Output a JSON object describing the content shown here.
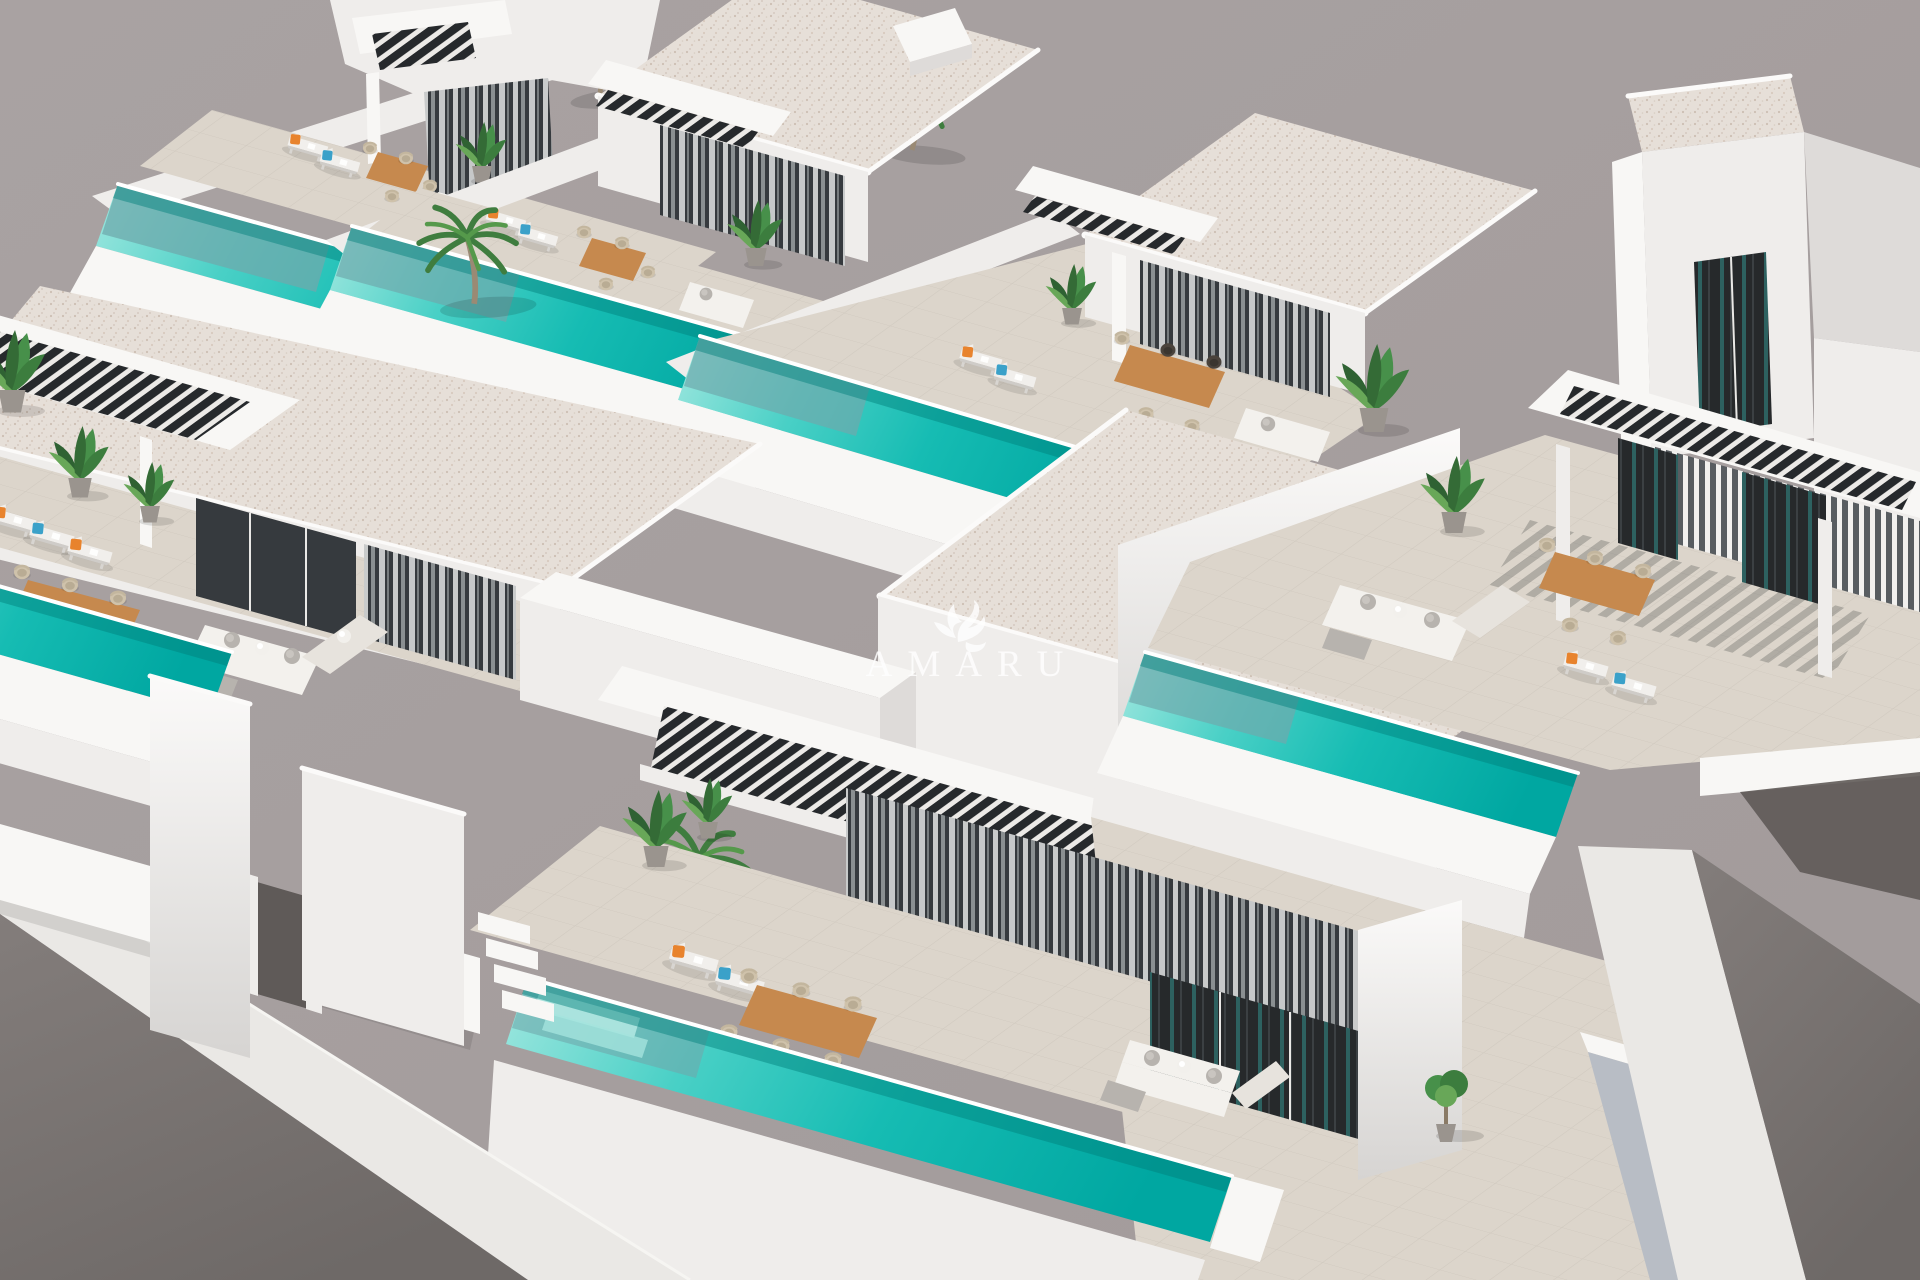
{
  "watermark": {
    "text": "AMARU",
    "logo": "amaru-bird-logo"
  },
  "scene": {
    "type": "3d-architectural-render",
    "subject": "Aerial view of a modern white villa development, each unit with a private turquoise lap pool",
    "villas_visible": 6,
    "elements": [
      "flat-roofed white villas",
      "black louvered pergolas",
      "turquoise pools",
      "sun loungers with orange and blue cushions",
      "teak outdoor dining tables with wicker chairs",
      "white corner sofas",
      "palm trees",
      "potted plants",
      "perimeter walls",
      "street with sidewalk"
    ]
  },
  "colors": {
    "bg": "#a9a2a2",
    "bg_edge": "#a29b9b",
    "white_top": "#f8f7f5",
    "white_front": "#efedeb",
    "white_side": "#dedbd9",
    "white_bright": "#fbfaf9",
    "wall_blue": "#b8bdc5",
    "roof_base": "#e6dfd8",
    "roof_dot1": "#cdbfb3",
    "roof_dot2": "#d8cabf",
    "terrace": "#dcd5cb",
    "terrace_line": "#c6bfb4",
    "facade_dark": "#363a3e",
    "glass_dark": "#26292b",
    "glass_teal": "#2e6f6d",
    "curtain_light": "#d0d2d3",
    "pergola_dark": "#26292c",
    "pool_light": "#9fe7df",
    "pool_mid": "#16bcb3",
    "pool_deep": "#00a7a1",
    "pool_shadow": "#007f7a",
    "rim_white": "#ffffff",
    "asphalt": "#7b7573",
    "asphalt_dark": "#5f5a58",
    "sidewalk": "#eae8e5",
    "wood": "#c6894e",
    "wicker": "#cfc2ab",
    "cushion_orange": "#e8832d",
    "cushion_blue": "#3ba1c9",
    "pillow_gray": "#b7b3ae",
    "sofa_white": "#f3f1ed",
    "plant_dark": "#2f6233",
    "plant_mid": "#47904a",
    "plant_light": "#68a758",
    "pot_gray": "#9a948e",
    "trunk": "#9a8a74",
    "watermark": "#ffffff"
  }
}
